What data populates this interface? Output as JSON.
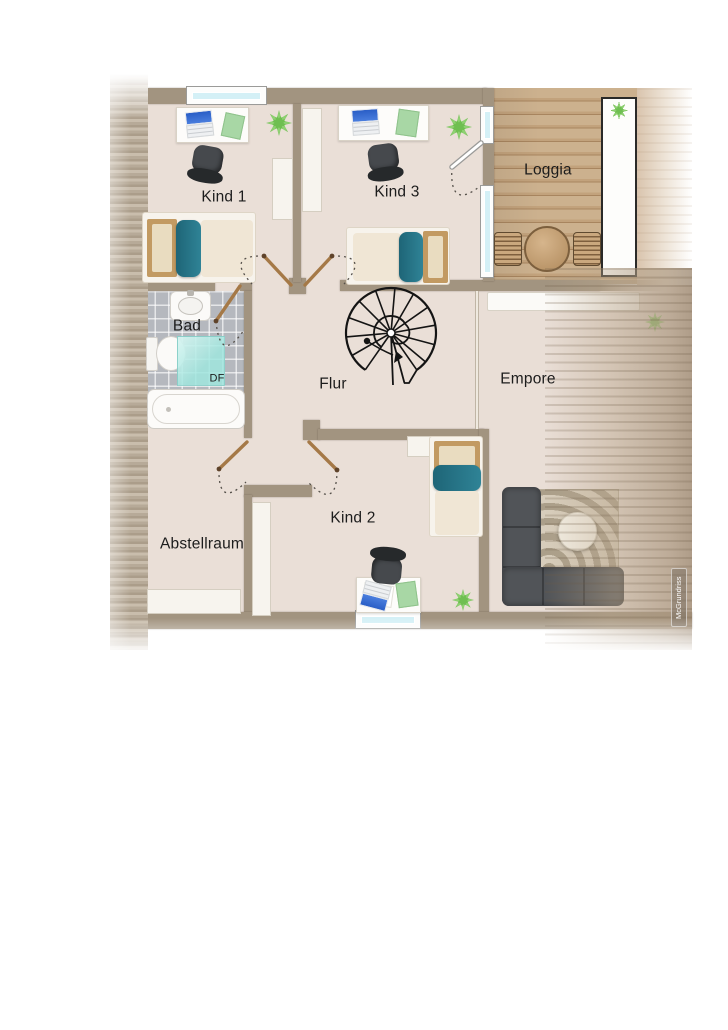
{
  "watermark": "McGrundriss",
  "rooms": {
    "kind1": {
      "label": "Kind 1",
      "furniture": [
        "desk",
        "office-chair",
        "laptop",
        "plant",
        "wardrobe",
        "single-bed"
      ]
    },
    "kind3": {
      "label": "Kind 3",
      "furniture": [
        "desk",
        "office-chair",
        "laptop",
        "plant",
        "wardrobe",
        "single-bed"
      ]
    },
    "loggia": {
      "label": "Loggia",
      "furniture": [
        "round-table",
        "slatted-chair",
        "slatted-chair",
        "planter-with-plants"
      ]
    },
    "bad": {
      "label": "Bad",
      "roof_window_label": "DF",
      "furniture": [
        "sink",
        "toilet",
        "shower",
        "roof-window",
        "bathtub"
      ]
    },
    "flur": {
      "label": "Flur",
      "furniture": [
        "spiral-staircase"
      ]
    },
    "empore": {
      "label": "Empore",
      "furniture": [
        "sideboard",
        "plant",
        "corner-sofa",
        "rug",
        "coffee-table"
      ]
    },
    "abstellraum": {
      "label": "Abstellraum",
      "furniture": [
        "low-shelf"
      ]
    },
    "kind2": {
      "label": "Kind 2",
      "furniture": [
        "single-bed",
        "shelf",
        "wardrobe",
        "desk",
        "office-chair",
        "laptop",
        "plant"
      ]
    }
  },
  "colors": {
    "wall": "#a29480",
    "floor": "#eadfd7",
    "bath_tile": "#b5b8be",
    "loggia_wood": "#c2a27c",
    "bed_teal": "#25707f",
    "plant_green": "#6cb24c",
    "sofa_gray": "#515458",
    "shower_cyan": "#a0e5de",
    "window_glass": "#d4f0f6",
    "laptop_blue": "#3a6fd8"
  }
}
